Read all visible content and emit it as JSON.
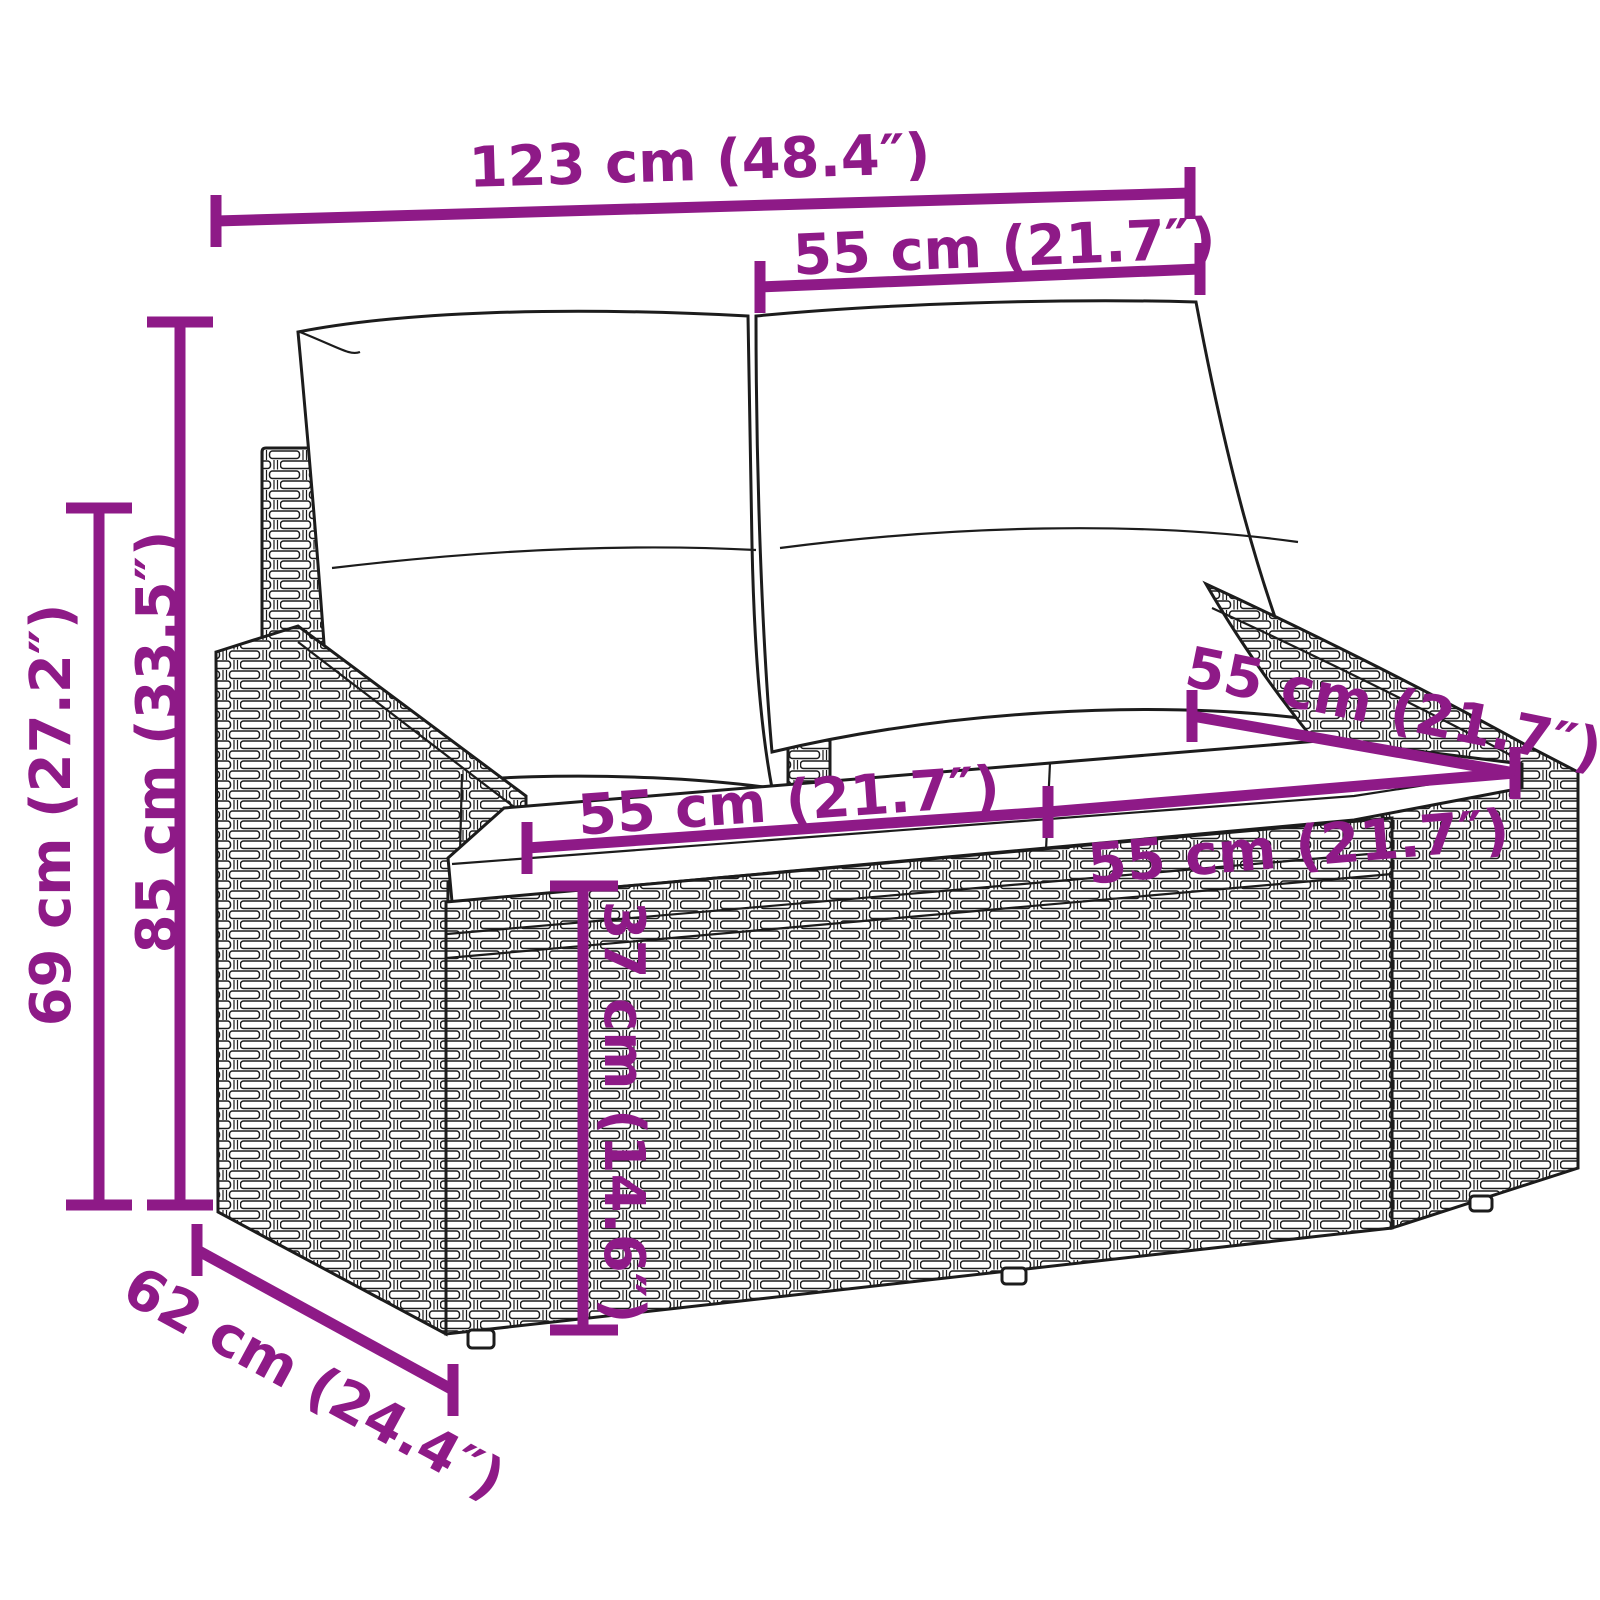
{
  "diagram": {
    "kind": "furniture-dimension-line-drawing",
    "background_color": "#ffffff",
    "accent_color": "#8e1a87",
    "line_color": "#1c1c1c",
    "dims": {
      "overall_width": {
        "label": "123 cm (48.4″)",
        "value_cm": 123,
        "value_in": 48.4
      },
      "backrest_width": {
        "label": "55 cm (21.7″)",
        "value_cm": 55,
        "value_in": 21.7
      },
      "seat_width_left": {
        "label": "55 cm (21.7″)",
        "value_cm": 55,
        "value_in": 21.7
      },
      "seat_width_right": {
        "label": "55 cm (21.7″)",
        "value_cm": 55,
        "value_in": 21.7
      },
      "seat_depth": {
        "label": "55 cm (21.7″)",
        "value_cm": 55,
        "value_in": 21.7
      },
      "seat_height": {
        "label": "37 cm (14.6″)",
        "value_cm": 37,
        "value_in": 14.6
      },
      "height_total": {
        "label": "85 cm (33.5″)",
        "value_cm": 85,
        "value_in": 33.5
      },
      "height_armrest": {
        "label": "69 cm (27.2″)",
        "value_cm": 69,
        "value_in": 27.2
      },
      "depth": {
        "label": "62 cm (24.4″)",
        "value_cm": 62,
        "value_in": 24.4
      }
    }
  }
}
